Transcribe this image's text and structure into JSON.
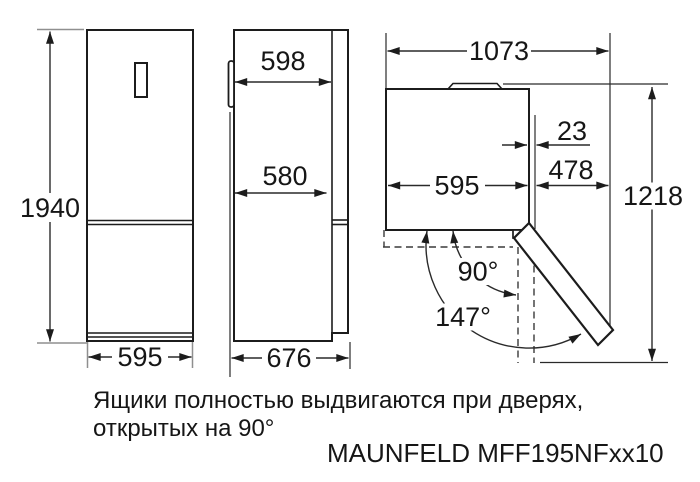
{
  "front_view": {
    "height_mm": "1940",
    "width_mm": "595"
  },
  "side_view": {
    "depth_with_door_mm": "598",
    "depth_body_mm": "580",
    "depth_total_mm": "676"
  },
  "top_view": {
    "total_width_door_open_mm": "1073",
    "door_clearance_mm": "23",
    "door_projection_mm": "478",
    "cabinet_width_mm": "595",
    "depth_door_open_mm": "1218",
    "angle_open": "90°",
    "angle_max": "147°"
  },
  "footnote": {
    "line1": "Ящики полностью выдвигаются при дверях,",
    "line2": "открытых на 90°"
  },
  "model": "MAUNFELD MFF195NFxx10",
  "colors": {
    "background": "#ffffff",
    "line": "#1c1c1c",
    "text": "#161616"
  }
}
